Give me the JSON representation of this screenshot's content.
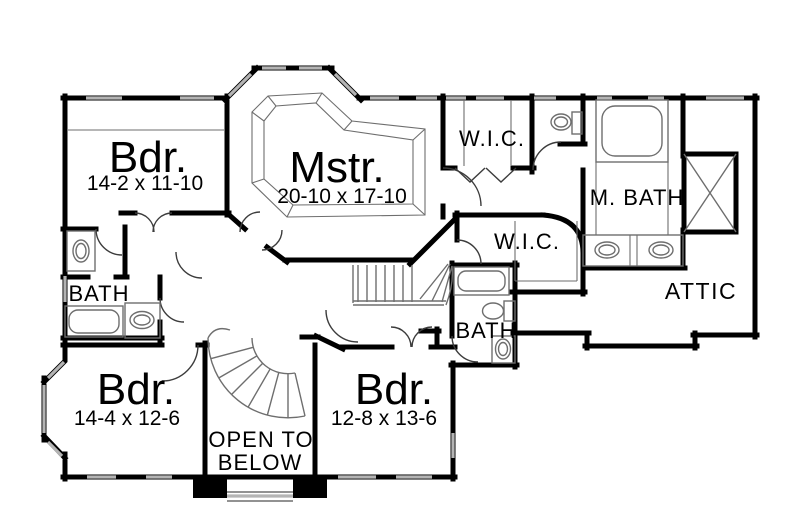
{
  "plan": {
    "colors": {
      "wall": "#000000",
      "line": "#6e6e6e",
      "window": "#b4b4b4",
      "door": "#3c3c3c",
      "bg": "#ffffff"
    },
    "rooms": {
      "bedroom1": {
        "name": "Bdr.",
        "dims": "14-2 x 11-10"
      },
      "master": {
        "name": "Mstr.",
        "dims": "20-10 x 17-10"
      },
      "wic1": {
        "name": "W.I.C."
      },
      "wic2": {
        "name": "W.I.C."
      },
      "master_bath": {
        "name": "M. BATH"
      },
      "attic": {
        "name": "ATTIC"
      },
      "bath1": {
        "name": "BATH"
      },
      "bath2": {
        "name": "BATH"
      },
      "bedroom2": {
        "name": "Bdr.",
        "dims": "14-4 x 12-6"
      },
      "bedroom3": {
        "name": "Bdr.",
        "dims": "12-8 x 13-6"
      },
      "open_to_below": {
        "line1": "OPEN TO",
        "line2": "BELOW"
      }
    }
  }
}
